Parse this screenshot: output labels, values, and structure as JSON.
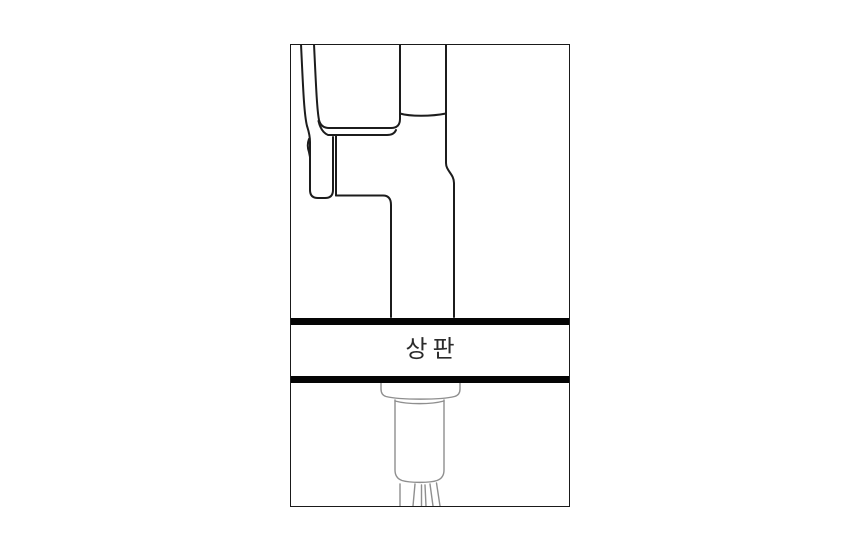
{
  "diagram": {
    "title": "faucet-countertop-installation-diagram",
    "label": "상판",
    "colors": {
      "line": "#1c1c1c",
      "undercounter_line": "#8f8f8f",
      "slab": "#050505",
      "border": "#1a1a1a",
      "label_color": "#2b2b2b",
      "background": "#ffffff"
    }
  }
}
